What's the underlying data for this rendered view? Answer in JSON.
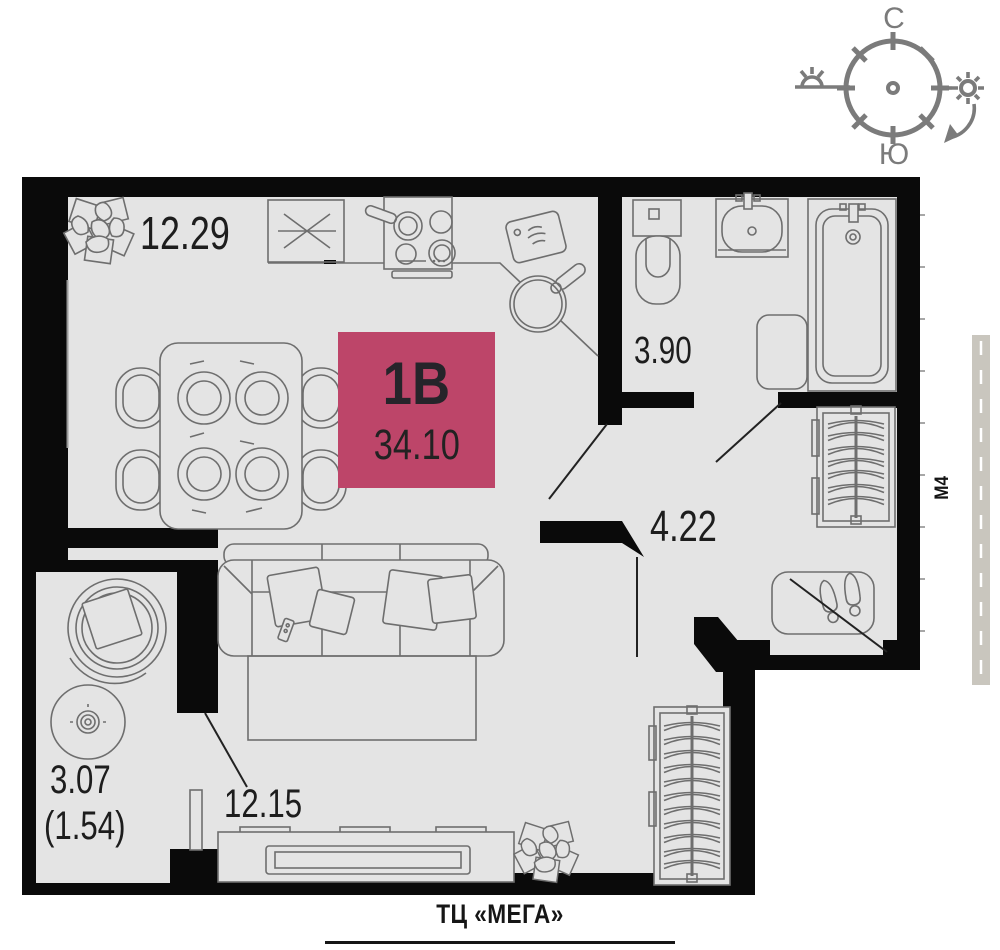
{
  "unit": {
    "label": "1В",
    "total_area": "34.10"
  },
  "rooms": {
    "kitchen_living": {
      "area": "12.29"
    },
    "bathroom": {
      "area": "3.90"
    },
    "hallway": {
      "area": "4.22"
    },
    "living": {
      "area": "12.15"
    },
    "balcony": {
      "area": "3.07",
      "area_reduced": "(1.54)"
    }
  },
  "compass": {
    "north": "С",
    "south": "Ю"
  },
  "road": {
    "label": "М4"
  },
  "footer": {
    "landmark": "ТЦ «МЕГА»"
  },
  "colors": {
    "accent": "#bd4569",
    "walls": "#0a0a0a",
    "room_fill": "#e4e4e4",
    "furniture_line": "#6e6e6e",
    "compass": "#7b7b7b",
    "road_fill": "#c9c6be"
  }
}
